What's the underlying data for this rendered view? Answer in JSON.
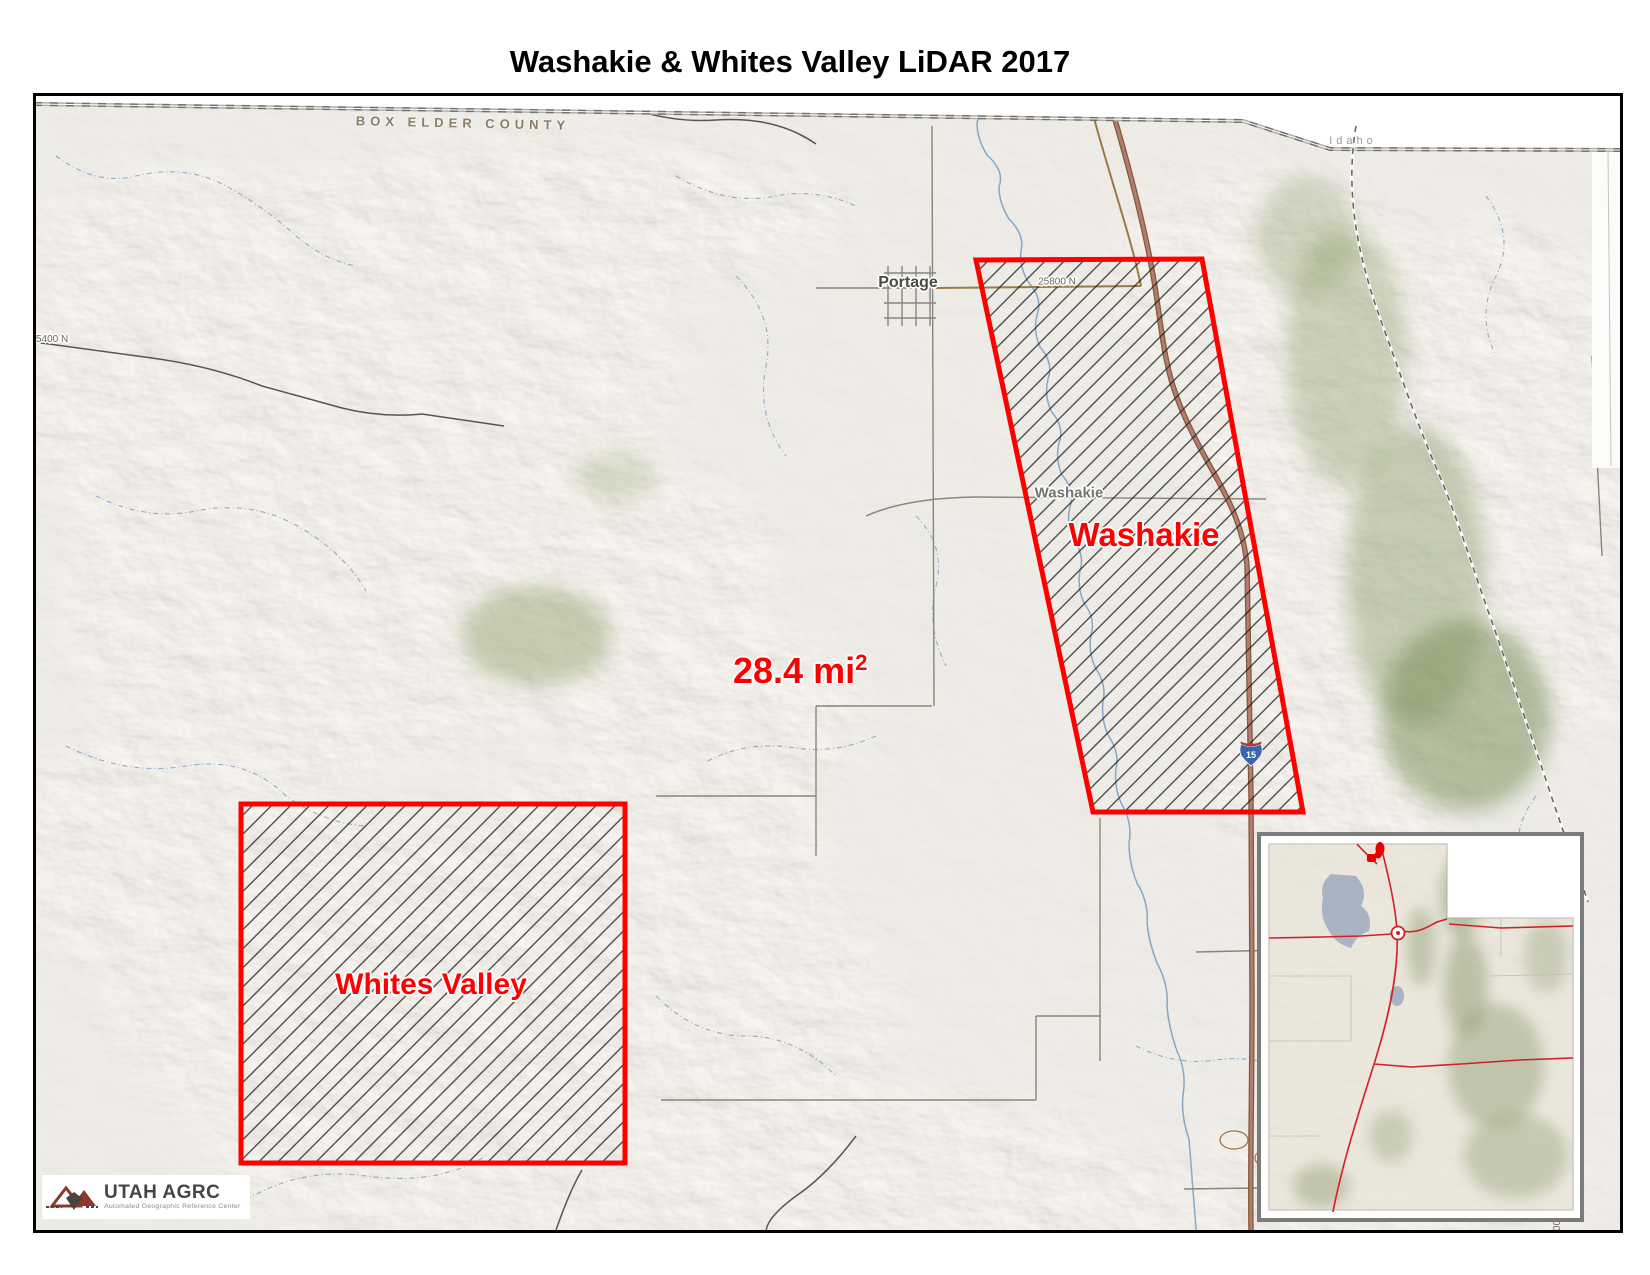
{
  "title": "Washakie & Whites Valley LiDAR 2017",
  "colors": {
    "region_border": "#ff0000",
    "region_label": "#ff0000",
    "hatch": "#1c1c1c",
    "highway_fill": "#b57a72",
    "highway_casing": "#7d5c39",
    "stream": "#7da3c4",
    "county_label": "#8b7d68",
    "state_label": "#9a9a9a",
    "inset_road": "#cf2126",
    "inset_lake": "#a9b3c1"
  },
  "map": {
    "county_label": "BOX ELDER COUNTY",
    "state_label": "Idaho",
    "area_label": {
      "value": "28.4 mi",
      "sup": "2"
    },
    "regions": [
      {
        "label": "Washakie"
      },
      {
        "label": "Whites Valley"
      }
    ],
    "towns": {
      "portage": "Portage",
      "washakie": "Washakie"
    },
    "roads": {
      "r25800": "25800 N",
      "r5400": "5400 N",
      "partial": "00"
    },
    "shield": "15"
  },
  "logo": {
    "name": "UTAH AGRC",
    "subtitle": "Automated Geographic Reference Center"
  }
}
